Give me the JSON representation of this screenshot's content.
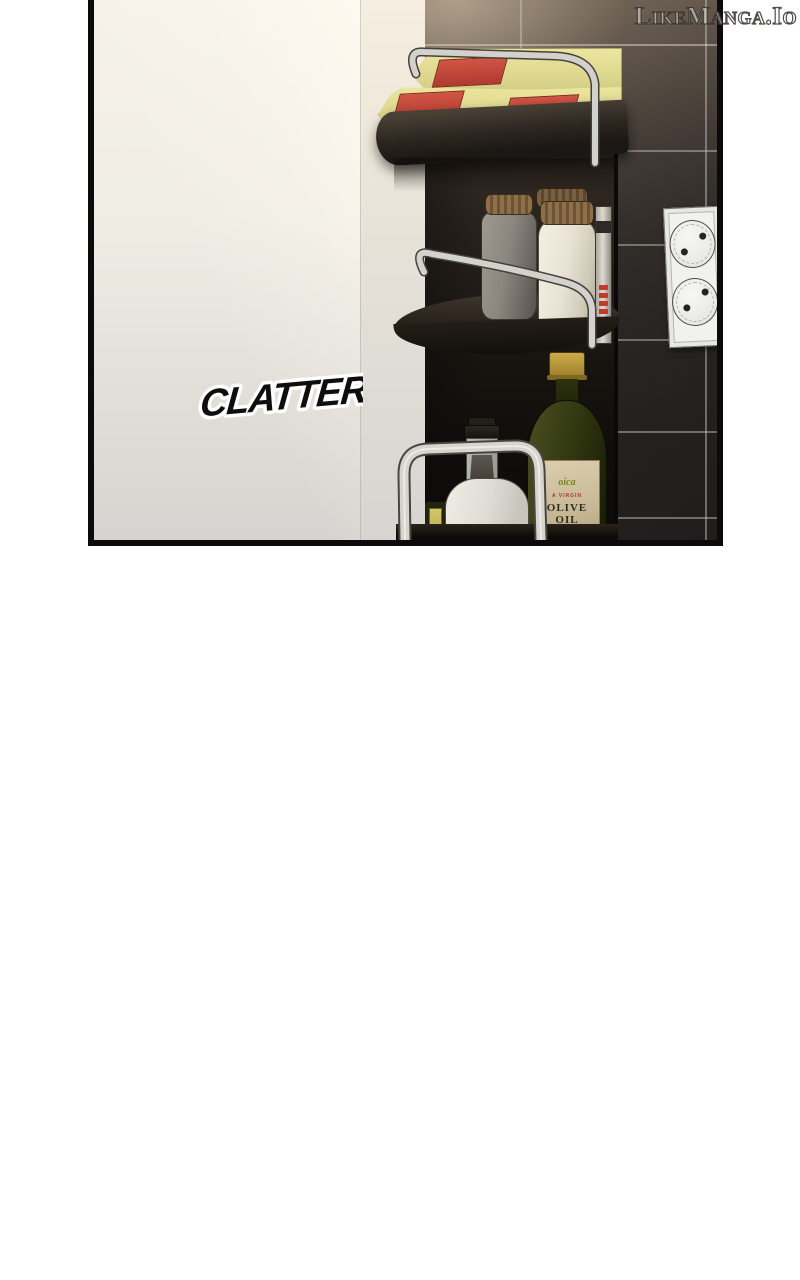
{
  "watermark": {
    "text": "LikeManga.Io"
  },
  "sfx": {
    "text": "CLATTER"
  },
  "shelf": {
    "olive_oil_label": {
      "script": "oica",
      "small": "A VIRGIN",
      "big": "OLIVE OIL"
    },
    "items": [
      "pasta packages",
      "spice jars",
      "canister",
      "olive oil bottle",
      "glass bottle",
      "red tube"
    ]
  },
  "colors": {
    "page_background": "#ffffff",
    "panel_border": "#0b0b0b",
    "white_wall": "#f0ede5",
    "tile_wall_dark": "#252321",
    "tile_grout": "#cdc9c3",
    "bag_yellow": "#ded78f",
    "bag_label_red": "#b03a2f",
    "chrome_rail": "#d4d2cc",
    "jar_gray": "#8b877f",
    "jar_cream": "#e8e3d4",
    "lid_brown": "#6d5334",
    "olive_bottle_green": "#353b11",
    "olive_cap_gold": "#b5953b",
    "label_beige": "#c5b693",
    "outlet_white": "#f1f1ee",
    "sfx_fill": "#0e0e0e",
    "sfx_outline": "#ffffff"
  }
}
